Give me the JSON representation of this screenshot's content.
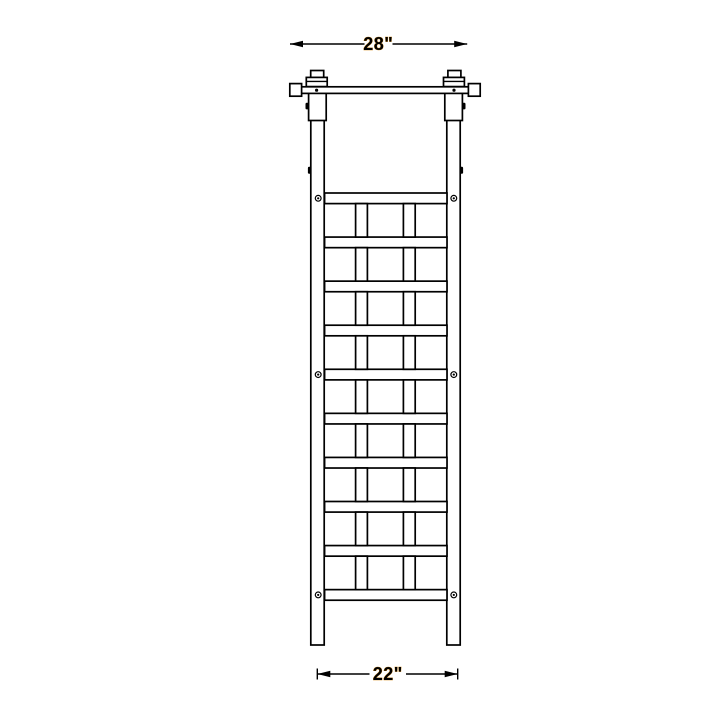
{
  "figure": {
    "subject": "garden trellis front elevation line drawing",
    "background_color": "#ffffff",
    "line_color": "#000000",
    "dimension_label_color": "#000000"
  },
  "dimensions": {
    "top": {
      "label": "28\""
    },
    "bottom": {
      "label": "22\""
    }
  },
  "structure": {
    "posts": 2,
    "finials": 2,
    "top_rail_end_caps": 2,
    "lattice": {
      "rail_count": 10,
      "opening_rows": 9,
      "bars_per_row": 2,
      "screw_rail_positions": [
        1,
        5,
        10
      ]
    }
  }
}
